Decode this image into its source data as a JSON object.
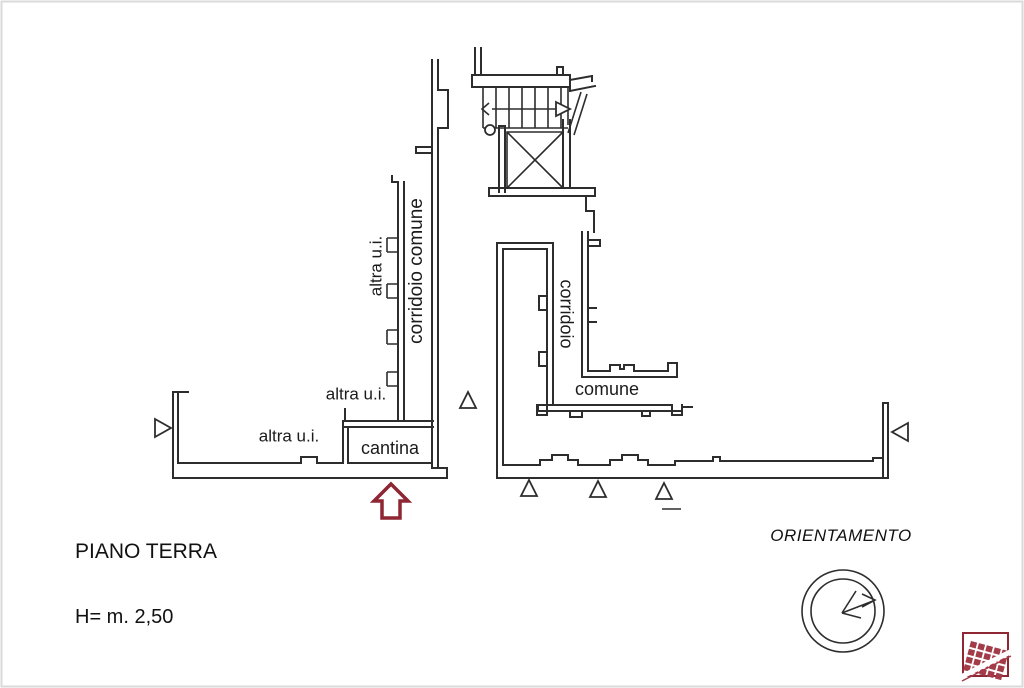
{
  "page": {
    "floor_title": "PIANO TERRA",
    "height_note": "H= m. 2,50",
    "orientation_title": "ORIENTAMENTO"
  },
  "plan_labels": {
    "altra_ui_top": "altra u.i.",
    "corridoio_comune": "corridoio comune",
    "altra_ui_mid": "altra u.i.",
    "altra_ui_left": "altra u.i.",
    "cantina": "cantina",
    "corridoio": "corridoio",
    "comune": "comune"
  },
  "icons": {
    "entrance_arrow": "entrance-arrow-up",
    "compass": "orientation-compass",
    "stairs": "staircase-with-direction-arrow",
    "elevator": "elevator-shaft",
    "door_markers": "triangle-opening-marker",
    "logo": "cadastral-agency-logo"
  },
  "colors": {
    "line": "#2d2d2d",
    "accent_red": "#8e2633",
    "logo_red": "#a33b49",
    "background": "#ffffff"
  }
}
